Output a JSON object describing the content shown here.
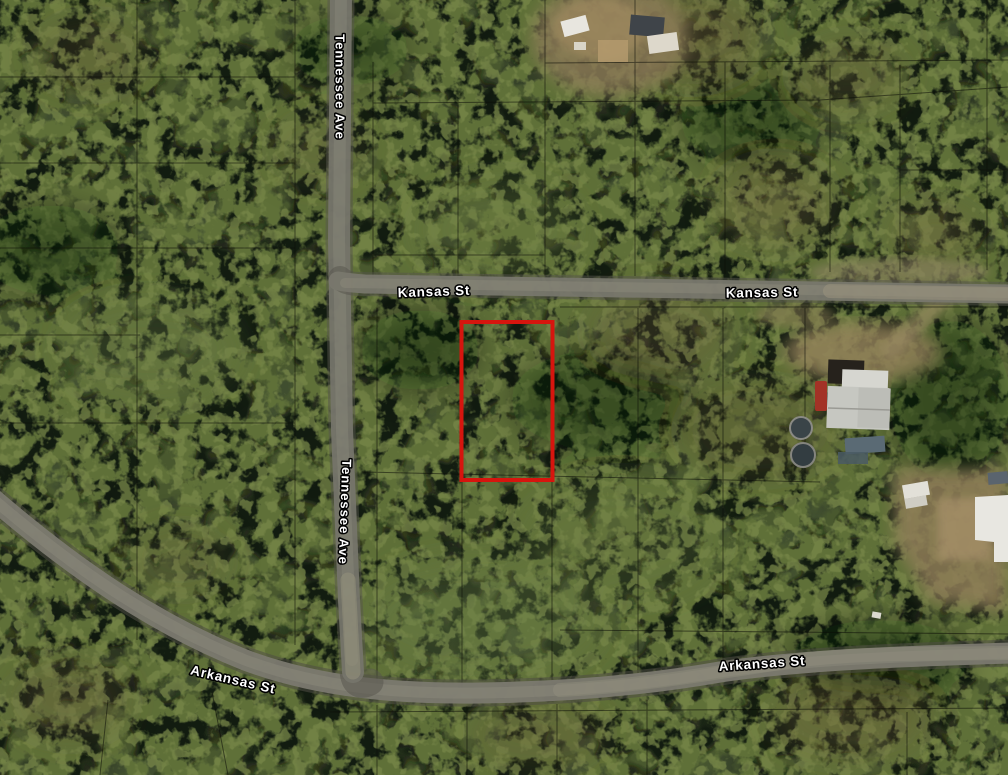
{
  "map": {
    "streets": {
      "tennessee": "Tennessee Ave",
      "kansas": "Kansas St",
      "arkansas": "Arkansas St"
    },
    "parcel_highlight": {
      "color": "#d6150e"
    },
    "colors": {
      "forest_base": "#2c3622",
      "road_surface": "#7b796f",
      "parcel_line": "#0c0e08",
      "label_fill": "#ffffff",
      "label_outline": "#000000",
      "clearing_sand": "#8f7d58",
      "house_roof": "#c6c7c1",
      "truck_red": "#a33226"
    }
  }
}
